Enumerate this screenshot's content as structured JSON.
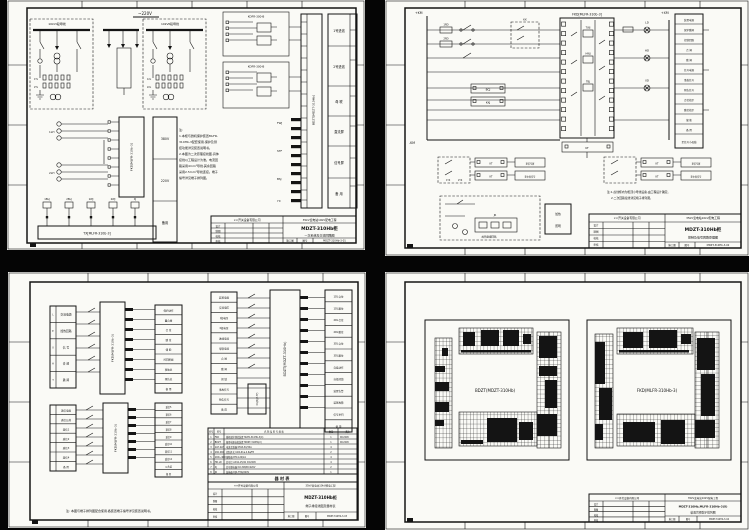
{
  "colors": {
    "bg": "#050505",
    "paper": "#fafaf6",
    "ink": "#141414"
  },
  "tl": {
    "bus_label": "~220V",
    "box1_title": "10kVⅠ段母线",
    "box2_title": "10kVⅡ段母线",
    "ct_rows": [
      "1TL",
      "2TL",
      "1XL",
      "2XL"
    ],
    "lh1": "1LH",
    "lh2": "2LH",
    "relay1": "KDFR-300-B",
    "relay2": "KDFR-300-B",
    "strip_label": "BDZT[MDZT-310Hb]",
    "fkd_label": "FKD[MLFR-310b-3]",
    "aux_rows": [
      "380V",
      "220V",
      "备用"
    ],
    "right_rows": [
      "1号进线",
      "2号进线",
      "母 联",
      "直流屏",
      "信号屏",
      "备 用"
    ],
    "tx_label": "TX[MLFR-310b-3]",
    "risers": [
      "1BLJ",
      "2BLJ",
      "1WJ",
      "2WJ",
      "XJ"
    ],
    "stub_groups": [
      "FWJ",
      "STF",
      "BSJ",
      "YX"
    ],
    "note_lines": [
      "注:",
      "1.本柜与微机保护装置MLFR-",
      "310Hb-3配套使用,保护及测",
      "控功能详见装置说明书。",
      "2.本图为二次原理接线图,具体",
      "接线以工程设计为准。电流回",
      "路采用4mm²导线,其余回路",
      "采用2.5mm²导线连接。端子",
      "编号详见端子排列图。"
    ],
    "tb": {
      "header_left": "××开关设备有限公司",
      "header_right": "35kV变电站10kV配电工程",
      "title": "MDZT-310Hb柜",
      "subtitle": "一次系统及交流回路图",
      "stage": "施工图",
      "no_label": "图号",
      "drawing_no": "MDZT-310Hb-3-01",
      "rev_rows": [
        "设计",
        "制图",
        "校核",
        "审核"
      ]
    }
  },
  "tr": {
    "rail_pos": "+KM",
    "rail_neg": "-KM",
    "rail_pos2": "+XM",
    "fuse1": "1RD",
    "fuse2": "2RD",
    "kk_label": "KK",
    "bcj": "BCJ",
    "kkj": "KKJ",
    "block_title": "FKD[MLFR-310b-3]",
    "coils": [
      "TWJ",
      "HWJ",
      "TBJ"
    ],
    "lamp1": "LD",
    "lamp2": "HD",
    "lamp3": "XD",
    "kt_bottom": "KT",
    "right_rows": [
      "装置电源",
      "保护跳闸",
      "控制回路",
      "合 闸",
      "跳 闸",
      "信号电源",
      "事故信号",
      "预告信号",
      "合位指示",
      "跳位指示",
      "储 能",
      "备 用"
    ],
    "right_last": "至信号小母线",
    "yk1": "1YK",
    "yk2": "2YK",
    "kt_label": "KT",
    "to_signal": "至信号屏",
    "to_signal2": "至中央信号",
    "heater_label": "加热驱潮回路",
    "jr": "JR",
    "box_rows": [
      "加热",
      "照明"
    ],
    "note_lines": [
      "注:1.虚线框内为柜顶小母线设备,由工程设计确定。",
      "2.二次回路接线详见端子排列图。"
    ],
    "tb": {
      "header_left": "××开关设备有限公司",
      "header_right": "35kV变电站10kV配电工程",
      "title": "MDZT-310Hb柜",
      "subtitle": "控制及信号回路原理图",
      "stage": "施工图",
      "no_label": "图号",
      "drawing_no": "MDZT-310Hb-3-02",
      "rev_rows": [
        "设计",
        "制图",
        "校核",
        "审核"
      ]
    }
  },
  "bl": {
    "t1": [
      "交流电源",
      "加热回路",
      "信 号",
      "合 闸",
      "跳 闸"
    ],
    "t1k": [
      "L",
      "E",
      "X",
      "H",
      "T"
    ],
    "t1r": [
      "保护动作",
      "重合闸",
      "合 位",
      "跳 位",
      "储 能",
      "控回断线",
      "事故总",
      "预告总",
      "备 用"
    ],
    "t2": [
      "遥信电源",
      "遥信公共",
      "遥信1",
      "遥信2",
      "遥信3",
      "遥信4",
      "备 用"
    ],
    "t2r": [
      "遥信5",
      "遥信6",
      "遥信7",
      "遥信8",
      "遥信9",
      "遥信10",
      "遥信11",
      "遥信12",
      "公共端",
      "备 用"
    ],
    "t3": [
      "装置电源",
      "交流电压",
      "Ⅰ段电压",
      "Ⅱ段电压",
      "进线电流",
      "母联电流",
      "合 闸",
      "跳 闸",
      "闭 锁",
      "事故信号",
      "预告信号",
      "备 用"
    ],
    "t3r": [
      "1DL合位",
      "1DL跳位",
      "2DL合位",
      "2DL跳位",
      "3DL合位",
      "3DL跳位",
      "自投动作",
      "自投闭锁",
      "装置告警",
      "装置故障",
      "信号复归",
      "备 用"
    ],
    "fkd1": "FKD(MLFR-310b-3)",
    "fkd2": "FKD(MLFR-310b-3)",
    "bdzt": "BDZT(MDZT-310Hb)",
    "kgjb": "KGJB(JZ-7Y)",
    "bom_caption": "器 材 表",
    "bom_header": [
      "序号",
      "符号",
      "名 称 及 型 号 规 格",
      "数量",
      "备注"
    ],
    "bom_rows": [
      [
        "1",
        "FKD",
        "微机保护测控装置 MLFR-310Hb-3(X)",
        "1",
        "DC220V"
      ],
      [
        "2",
        "BDZT",
        "备用电源自投装置 MDZT-310Hb(X)",
        "1",
        "DC220V"
      ],
      [
        "3",
        "1LH.2LH",
        "电流互感器 KTLB-3X/3XA",
        "4",
        ""
      ],
      [
        "4",
        "1KK.2KK",
        "控制开关 LW2-Z1a.4.6a/F8",
        "2",
        ""
      ],
      [
        "5",
        "1RD~4RD",
        "熔断器 RT14-20/2A",
        "4",
        ""
      ],
      [
        "6",
        "HD.LD",
        "信号灯 AD11-25/41 DC220V",
        "4",
        ""
      ],
      [
        "7",
        "XJ",
        "信号继电器 DX-31B/DC220V",
        "2",
        ""
      ],
      [
        "8",
        "JR",
        "加热器 DJR-75W/220V",
        "1",
        ""
      ]
    ],
    "note": "注: 本图与端子排列图配合使用,各装置端子编号详见装置说明书。",
    "tb": {
      "header_left": "××开关设备有限公司",
      "header_right": "35kV变电站10kV配电工程",
      "title": "MDZT-310Hb柜",
      "subtitle": "端子排接线图及器材表",
      "stage": "施工图",
      "no_label": "图号",
      "drawing_no": "MDZT-310Hb-3-03",
      "rev_rows": [
        "设计",
        "制图",
        "校核",
        "审核"
      ]
    }
  },
  "br": {
    "label1": "BDZT(MDZT-310Hb)",
    "label2": "FKD(MLFR-310Hb-3)",
    "tb": {
      "header_left": "××开关设备有限公司",
      "header_right": "35kV变电站10kV配电工程",
      "title": "MDZT-310Hb,MLFR-310Hb-3(X)",
      "subtitle": "装置背视端子排列图",
      "stage": "施工图",
      "no_label": "图号",
      "drawing_no": "MDZT-310Hb-3-04",
      "rev_rows": [
        "设计",
        "制图",
        "校核",
        "审核"
      ]
    }
  }
}
